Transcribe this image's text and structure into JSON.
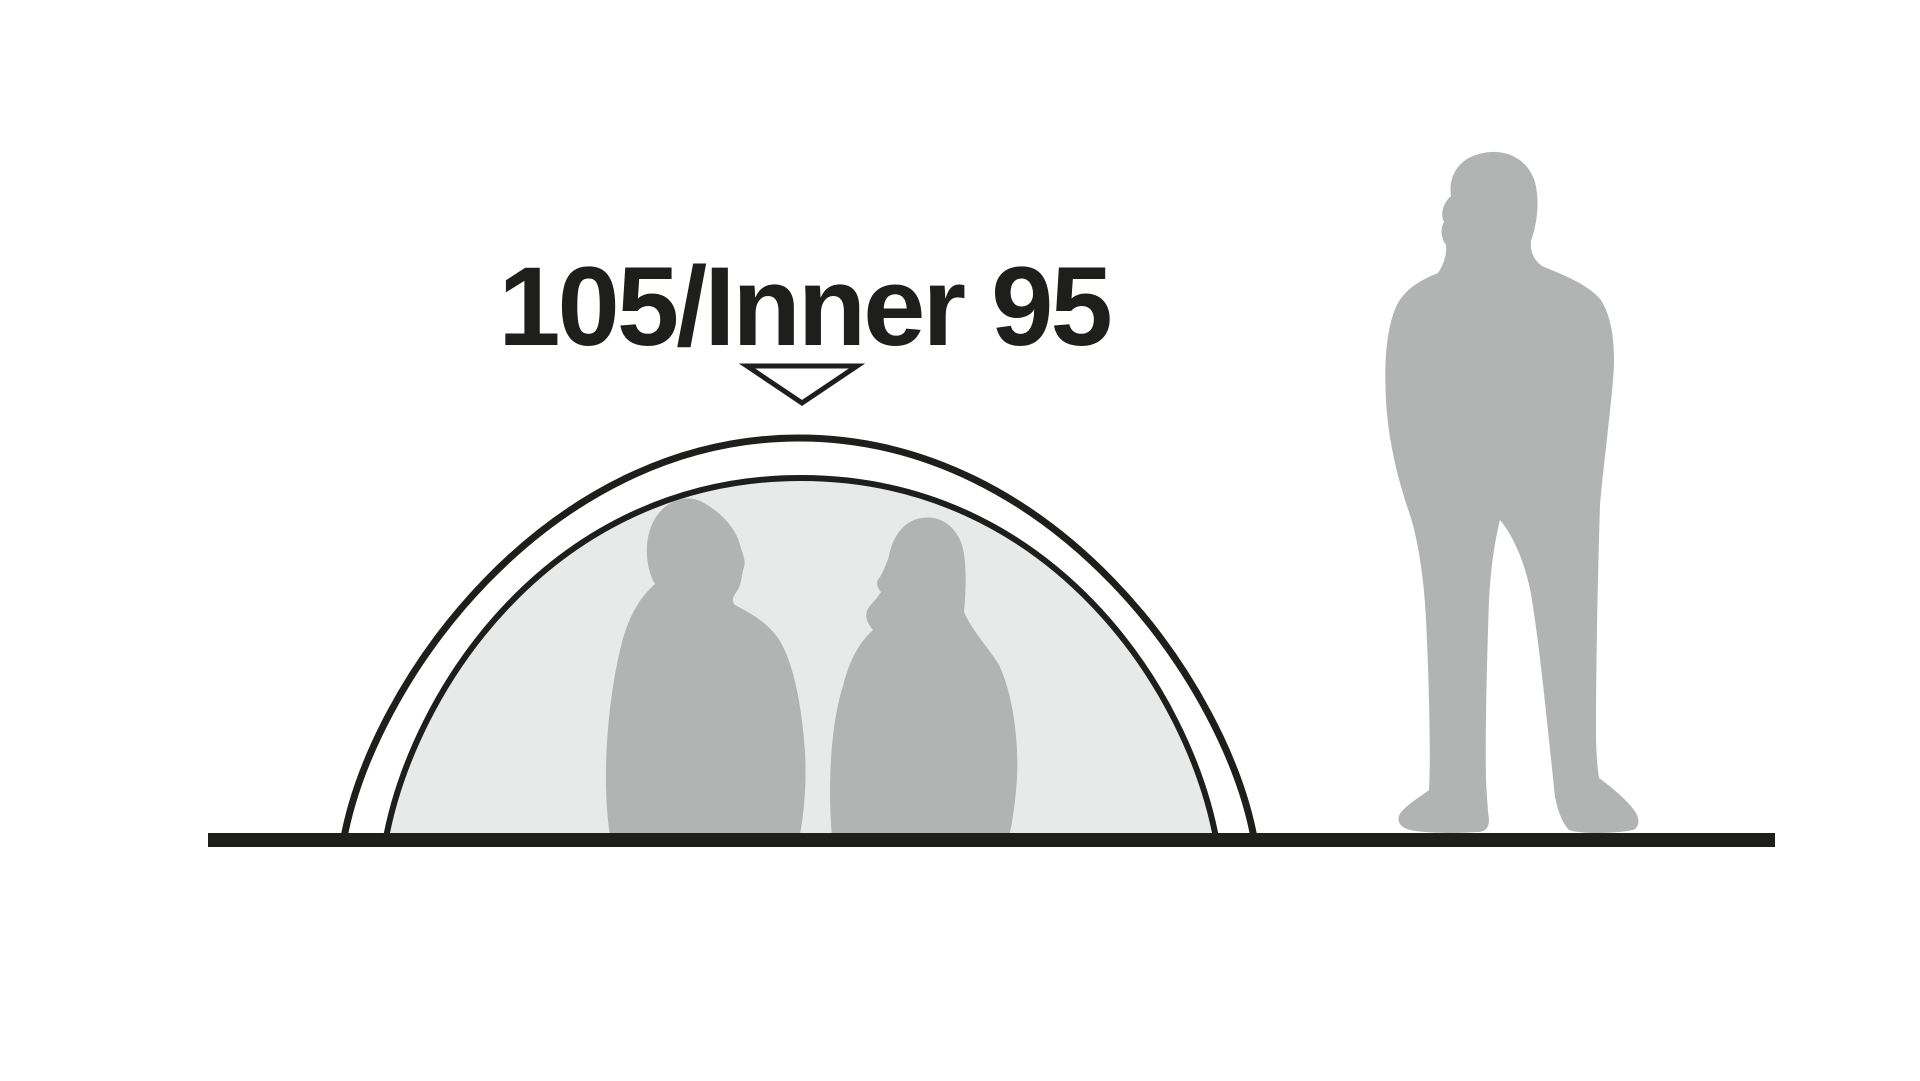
{
  "diagram": {
    "height_label": "105/Inner 95",
    "outer_height_cm": "105",
    "inner_height_cm": "95"
  },
  "colors": {
    "ink": "#1e1e1c",
    "silhouette": "#b2b3b3",
    "inner_tent": "#e8eae9",
    "marker_fill": "#ffffff",
    "background": "#ffffff"
  }
}
